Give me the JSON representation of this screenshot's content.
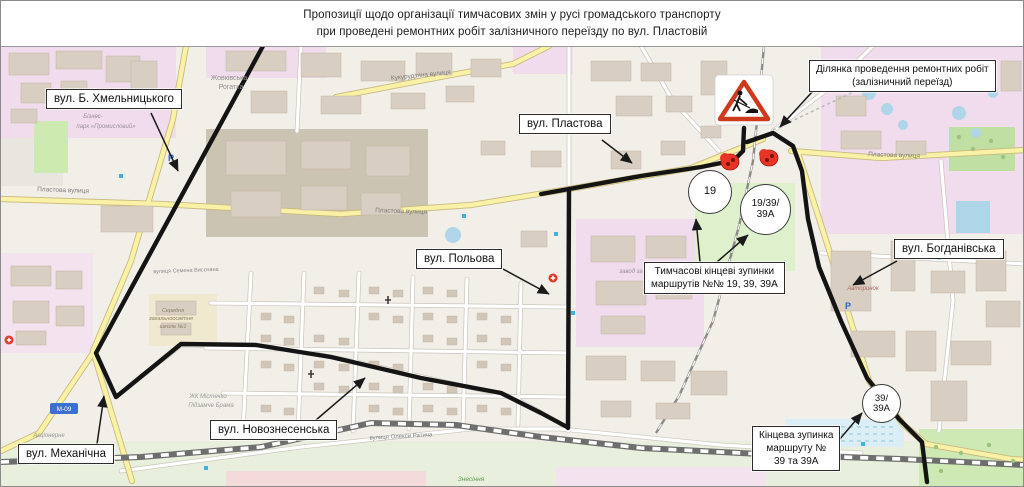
{
  "title": {
    "line1": "Пропозиції щодо організації тимчасових змін у русі громадського транспорту",
    "line2": "при проведені ремонтних робіт залізничного переїзду по вул. Пластовій"
  },
  "callouts": {
    "khmelnytskoho": {
      "text": "вул. Б. Хмельницького"
    },
    "plastova": {
      "text": "вул. Пластова"
    },
    "repair_area": {
      "lines": [
        "Ділянка проведення ремонтних робіт",
        "(залізничний переїзд)"
      ]
    },
    "polova": {
      "text": "вул. Польова"
    },
    "temp_stops": {
      "lines": [
        "Тимчасові кінцеві зупинки",
        "маршрутів №№ 19, 39, 39А"
      ]
    },
    "bohdanivska": {
      "text": "вул. Богданівська"
    },
    "final_stop": {
      "lines": [
        "Кінцева зупинка",
        "маршруту №",
        "39 та 39А"
      ]
    },
    "novoznesenska": {
      "text": "вул. Новознесенська"
    },
    "mekhanichna": {
      "text": "вул. Механічна"
    }
  },
  "badges": {
    "b19": {
      "lines": [
        "19"
      ]
    },
    "b19_39_39a": {
      "lines": [
        "19/39/",
        "39А"
      ]
    },
    "b39_39a": {
      "lines": [
        "39/",
        "39А"
      ]
    }
  },
  "map_labels": [
    {
      "text": "Жовківська",
      "x": 228,
      "y": 79,
      "size": 7,
      "color": "#8f8f8f"
    },
    {
      "text": "Рогатка",
      "x": 230,
      "y": 88,
      "size": 7,
      "color": "#8f8f8f"
    },
    {
      "text": "Кукурудзяна вулиця",
      "x": 420,
      "y": 76,
      "rot": -6,
      "size": 6.5,
      "color": "#7a7a7a"
    },
    {
      "text": "Пластова вулиця",
      "x": 62,
      "y": 191,
      "rot": 2,
      "size": 6.5,
      "color": "#7a7a7a"
    },
    {
      "text": "Пластова вулиця",
      "x": 400,
      "y": 212,
      "rot": 2,
      "size": 6.5,
      "color": "#7a7a7a"
    },
    {
      "text": "Пластова вулиця",
      "x": 893,
      "y": 156,
      "rot": 2,
      "size": 6.5,
      "color": "#7a7a7a"
    },
    {
      "text": "Бізнес-",
      "x": 92,
      "y": 117,
      "size": 6,
      "italic": true,
      "color": "#9a8fa0"
    },
    {
      "text": "парк «Промисловий»",
      "x": 105,
      "y": 127,
      "size": 6,
      "italic": true,
      "color": "#9a8fa0"
    },
    {
      "text": "вулиця Олекси Ратича",
      "x": 400,
      "y": 437,
      "rot": -3,
      "size": 6,
      "color": "#7a7a7a"
    },
    {
      "text": "вулиця Семена Височана",
      "x": 185,
      "y": 271,
      "rot": -2,
      "size": 5.5,
      "color": "#8a8a8a"
    },
    {
      "text": "Середня",
      "x": 172,
      "y": 311,
      "size": 5.5,
      "italic": true,
      "color": "#8a7f5f"
    },
    {
      "text": "загальноосвітня",
      "x": 170,
      "y": 319,
      "size": 5.5,
      "italic": true,
      "color": "#8a7f5f"
    },
    {
      "text": "школа №1",
      "x": 172,
      "y": 327,
      "size": 5.5,
      "italic": true,
      "color": "#8a7f5f"
    },
    {
      "text": "ЖК Містечко",
      "x": 207,
      "y": 397,
      "size": 6,
      "italic": true,
      "color": "#9a9a9a"
    },
    {
      "text": "Підзамче Брама",
      "x": 210,
      "y": 406,
      "size": 6,
      "italic": true,
      "color": "#9a9a9a"
    },
    {
      "text": "Акціонерне",
      "x": 48,
      "y": 436,
      "size": 6,
      "italic": true,
      "color": "#9a9a9a"
    },
    {
      "text": "типу «Райдуга»",
      "x": 48,
      "y": 462,
      "size": 6,
      "italic": true,
      "color": "#9a9a9a"
    },
    {
      "text": "завод за",
      "x": 630,
      "y": 272,
      "size": 6,
      "italic": true,
      "color": "#9a8fa0"
    },
    {
      "text": "Авторинок",
      "x": 862,
      "y": 289,
      "size": 6,
      "italic": true,
      "color": "#b06a6a"
    },
    {
      "text": "Знесіння",
      "x": 470,
      "y": 480,
      "size": 6.5,
      "italic": true,
      "color": "#5d9e4e"
    },
    {
      "text": "М-09",
      "x": 63,
      "y": 410,
      "size": 6.5,
      "color": "#ffffff",
      "shield": true
    }
  ],
  "colors": {
    "route": "#141414",
    "callout_border": "#2c2c2c",
    "stop_marker_red": "#e63427",
    "sign_red": "#cf3a1e",
    "road_yellow": "#f8f1a6",
    "industrial_pink": "#f0dcec",
    "park_green": "#cdebb0",
    "water_blue": "#aed6e8",
    "shield_blue": "#3b6fd1"
  }
}
